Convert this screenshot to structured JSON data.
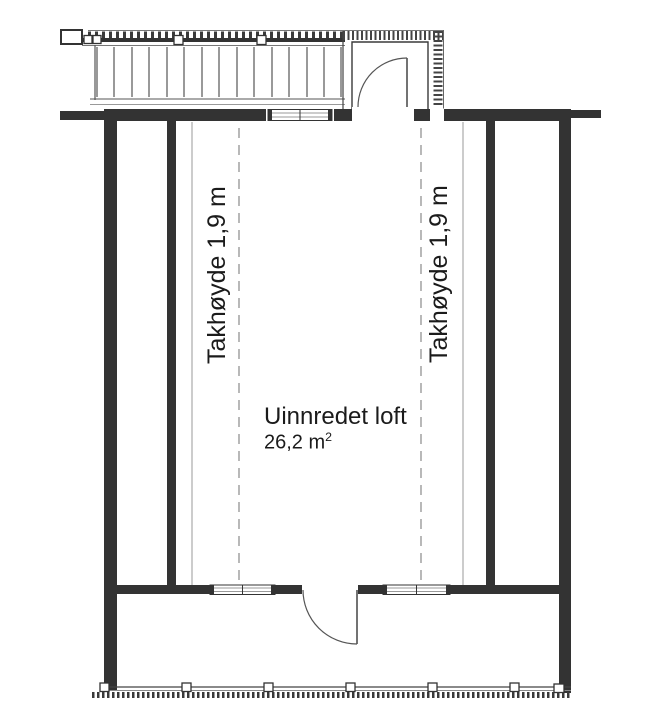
{
  "drawing": {
    "type": "floor-plan",
    "labels": {
      "ceiling_height_left": "Takhøyde 1,9 m",
      "ceiling_height_right": "Takhøyde 1,9 m",
      "room_name": "Uinnredet loft",
      "room_area": "26,2 m",
      "room_area_sup": "2"
    },
    "colors": {
      "background": "#ffffff",
      "wall": "#333333",
      "medium_line": "#555555",
      "light_line": "#999999",
      "text": "#1b1b1b"
    }
  }
}
